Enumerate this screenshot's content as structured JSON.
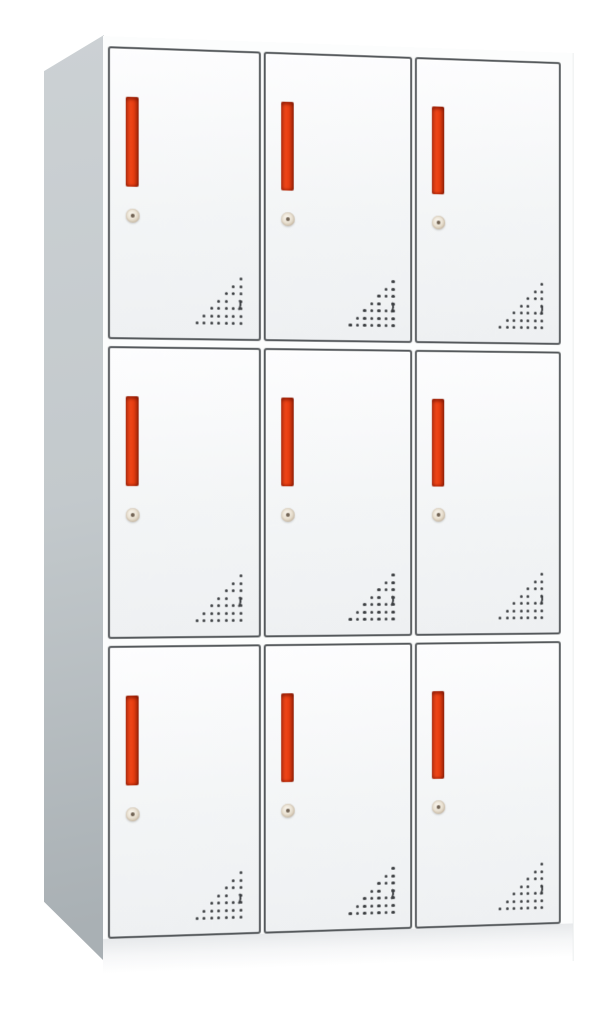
{
  "cabinet": {
    "name": "nine-door-steel-locker-cabinet",
    "rows": 3,
    "columns": 3,
    "door_count": 9,
    "features_per_door": [
      "red-pull-handle",
      "round-keyhole",
      "corner-vent-holes"
    ],
    "colors": {
      "background": "#ffffff",
      "cabinet_body": "#fcfdfd",
      "side_panel_light": "#ccd1d4",
      "side_panel_dark": "#a9b0b4",
      "door_face": "#f3f5f6",
      "door_border": "#54585b",
      "handle_bright": "#ee4517",
      "handle_dark": "#9c2609",
      "keyhole_face": "#e9e1d2",
      "vent_dot": "#3b3e41"
    },
    "vent_pattern": {
      "shape": "right-triangle",
      "alignment": "bottom-right",
      "rows": [
        1,
        2,
        3,
        4,
        5,
        6,
        7
      ],
      "crescent": {
        "row_from_top": 4,
        "position_from_right": 2
      }
    }
  }
}
